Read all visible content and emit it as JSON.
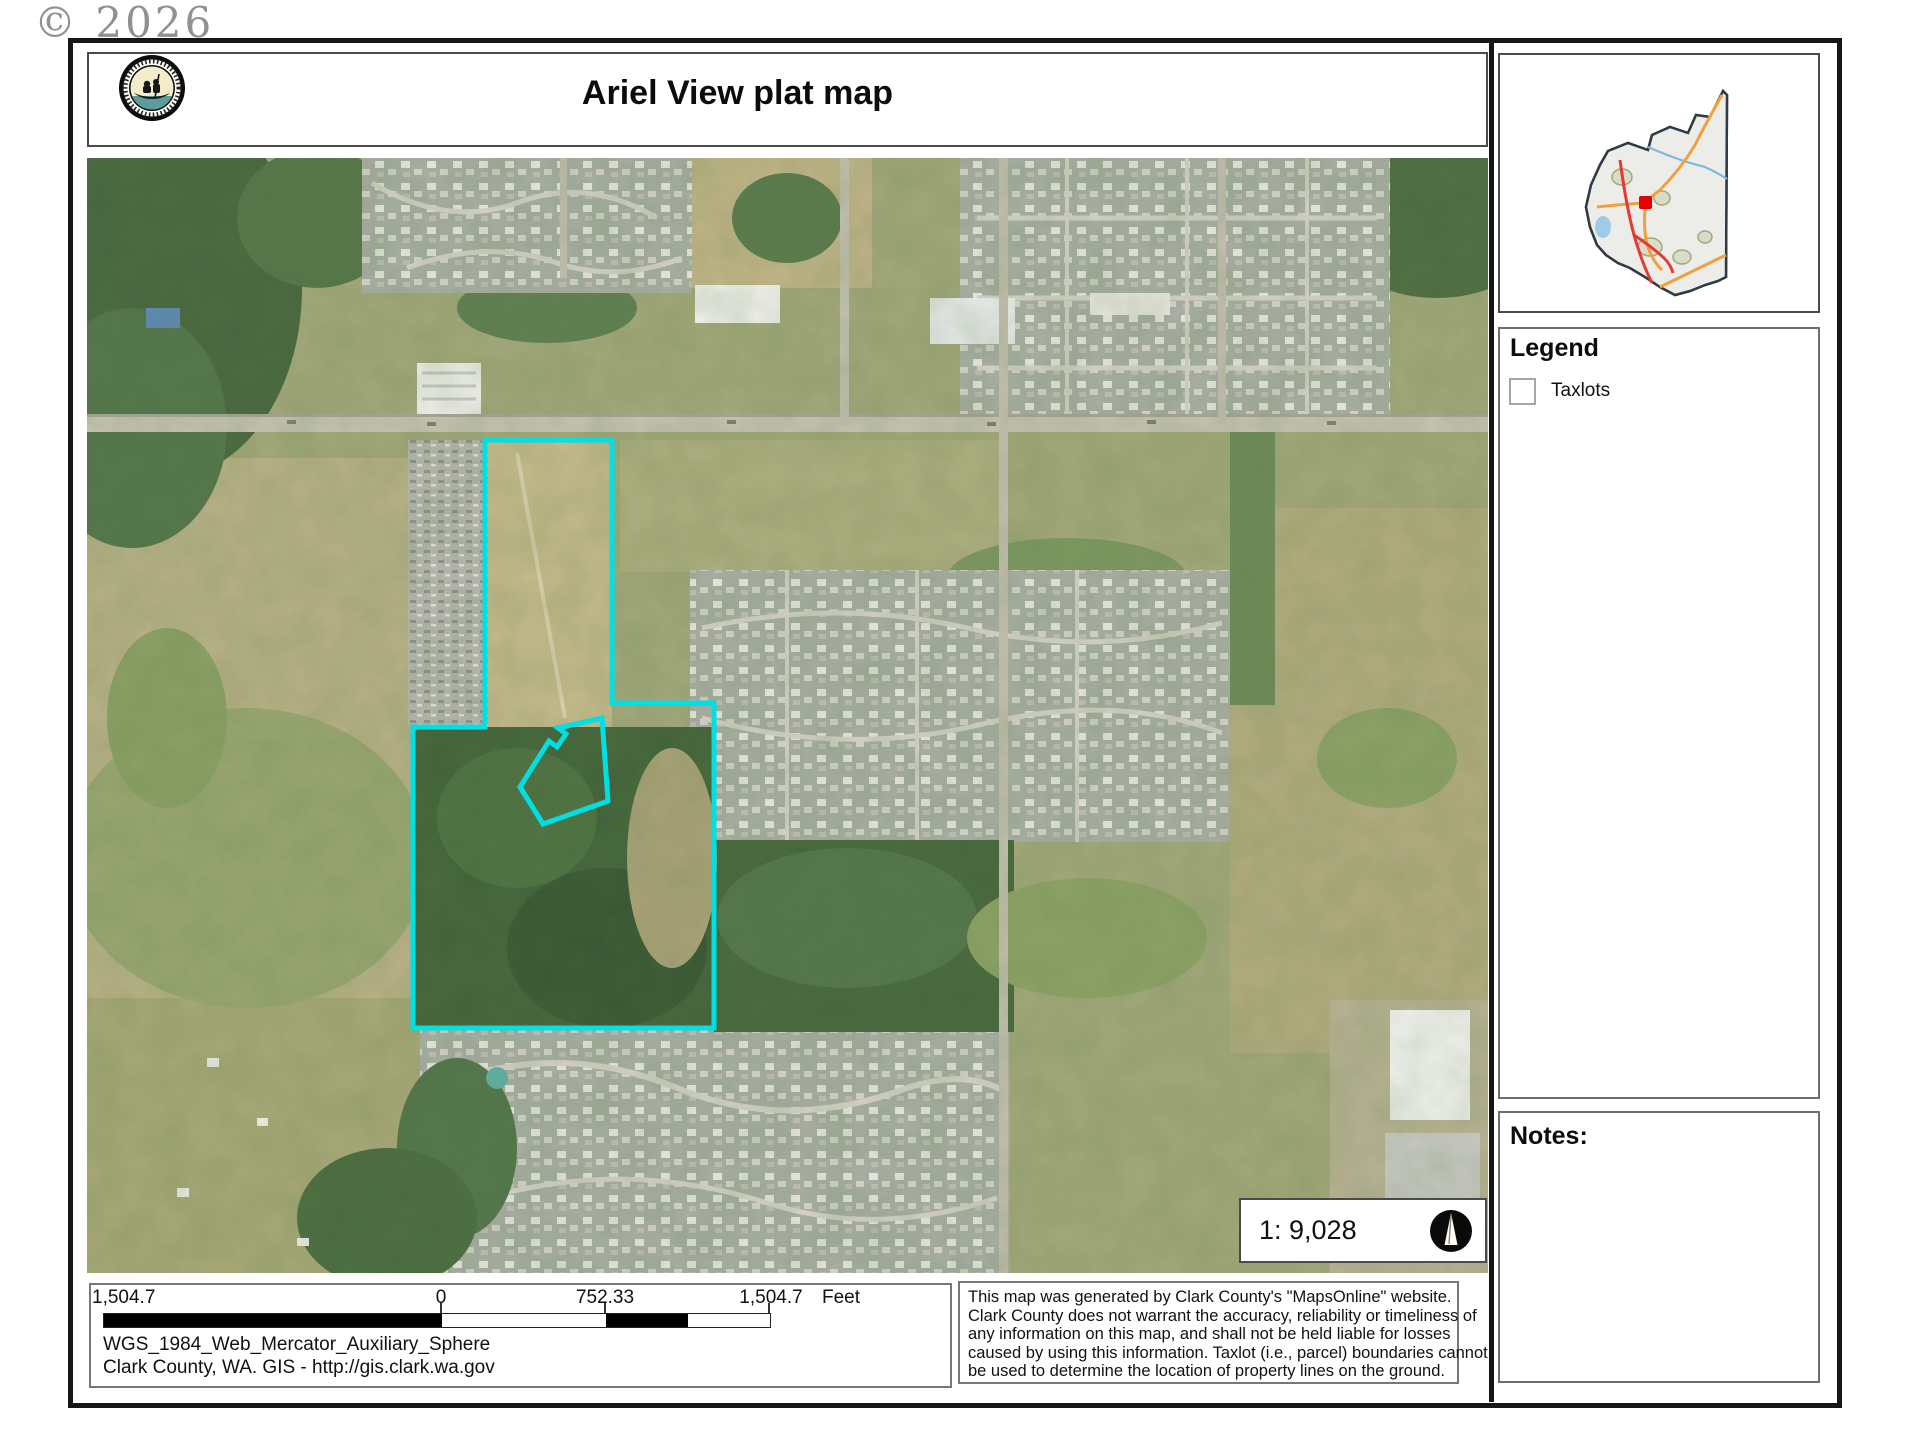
{
  "watermark": {
    "text": "© 2026"
  },
  "header": {
    "title": "Ariel View plat map"
  },
  "locator": {
    "marker_color": "#e60000"
  },
  "legend": {
    "title": "Legend",
    "items": [
      {
        "label": "Taxlots",
        "swatch": "empty-square"
      }
    ]
  },
  "notes": {
    "title": "Notes:"
  },
  "scale_box": {
    "ratio": "1: 9,028"
  },
  "scalebar": {
    "labels": [
      "1,504.7",
      "0",
      "752.33",
      "1,504.7"
    ],
    "unit": "Feet"
  },
  "credits": {
    "projection": "WGS_1984_Web_Mercator_Auxiliary_Sphere",
    "source": "Clark County, WA. GIS - http://gis.clark.wa.gov"
  },
  "disclaimer": {
    "lines": [
      "This map was generated by Clark County's \"MapsOnline\" website.",
      "Clark County does not warrant the accuracy, reliability or timeliness of",
      "any information on this map, and shall not be held liable for losses",
      "caused by using this information. Taxlot (i.e., parcel) boundaries cannot",
      "be used to determine the location of property lines on the ground."
    ]
  },
  "colors": {
    "plat_outline": "#00dfe4",
    "water": "#5fb0a8"
  },
  "icons": {
    "north_arrow": "circled-up-arrow",
    "logo": "clark-county-canoe-seal"
  }
}
